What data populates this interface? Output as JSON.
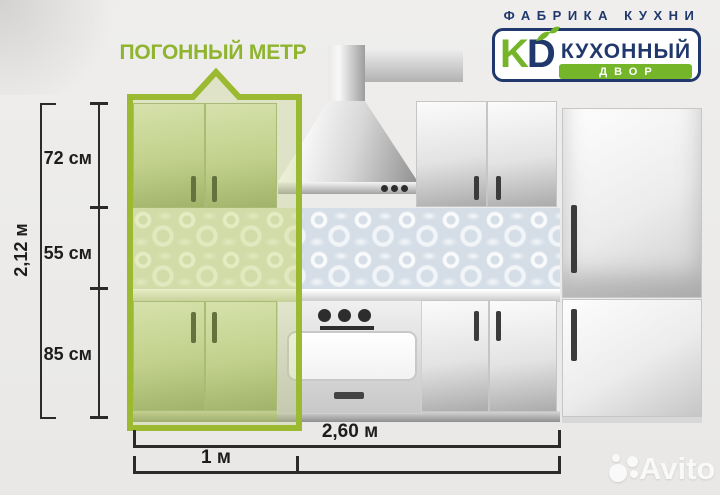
{
  "header": {
    "tagline": "ФАБРИКА КУХНИ",
    "logo": {
      "letter_k": "K",
      "letter_d": "D",
      "name_line1": "КУХОННЫЙ",
      "name_line2": "ДВОР",
      "navy": "#20386c",
      "green": "#74b52a"
    }
  },
  "callout": {
    "label": "ПОГОННЫЙ МЕТР",
    "frame_color": "#9cba31",
    "fill_color": "rgba(190,205,120,0.30)"
  },
  "dimensions": {
    "vertical": {
      "total": "2,12 м",
      "segments": [
        "72 см",
        "55 см",
        "85 см"
      ]
    },
    "horizontal": {
      "total": "2,60 м",
      "linear_meter": "1 м"
    }
  },
  "watermark": {
    "label": "Avito"
  }
}
